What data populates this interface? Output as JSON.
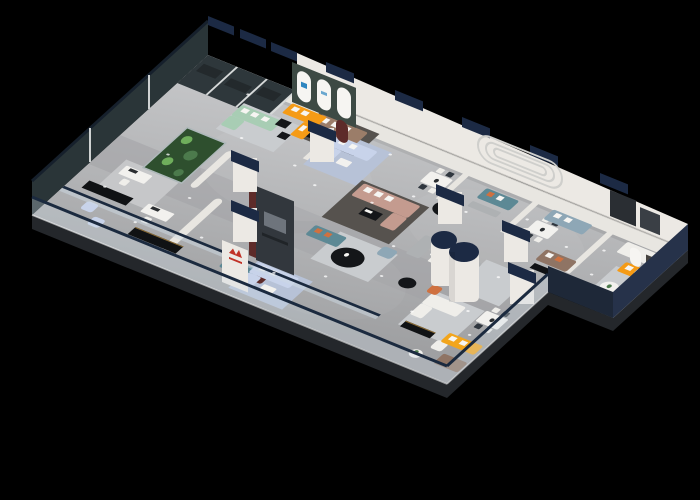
{
  "scene": {
    "description": "Isometric 3D cutaway render of a furniture showroom floor on a black background",
    "background": "#000000",
    "palette": {
      "bg": "#000000",
      "floor_light": "#c6c7c9",
      "floor_base": "#b2b3b5",
      "floor_dark": "#9b9c9e",
      "walkway": "#a2a3a5",
      "slab": "#24272b",
      "wall_white": "#ece9e4",
      "wall_flat": "#e8e6e1",
      "wall_shadow": "#cfccc7",
      "cap_navy": "#1c2a44",
      "glass_dark": "#2e373b",
      "glass_mullion": "#d6d9d9",
      "glass_fill": "#cdd9e4",
      "rail_navy": "#1b2a3f",
      "band_navy": "#1e2838",
      "band_navy_dark": "#26324a",
      "rug_light": "#c9cccf",
      "rug_blue": "#b7c2d7",
      "rug_dark": "#56524e",
      "sofa_white": "#efeeea",
      "sofa_mint": "#a8cdb4",
      "sofa_taupe": "#9b7d69",
      "sofa_brown": "#8f7464",
      "sofa_mauve": "#c49b8f",
      "sofa_bluelight": "#c8d3ea",
      "sofa_teal": "#5d8995",
      "sofa_bluegray": "#8ea7b6",
      "sofa_orange": "#f59b16",
      "sofa_yellow": "#f2a51c",
      "chair_terracotta": "#cf7140",
      "pillow_white": "#f6f5f2",
      "table_black": "#141619",
      "table_white": "#f2f1ee",
      "console_black": "#101214",
      "gold_trim": "#8a6b35",
      "plant_green": "#4c7a4c",
      "plant_bright": "#6fae5c",
      "terrarium_dark": "#2e4f2e",
      "maroon": "#5d2b29",
      "tv_dark": "#32373d",
      "tv_screen": "#6e747c",
      "logo_red": "#c13227",
      "teal_wall": "#3d4a44",
      "art_dark": "#45433f",
      "logo_blue": "#2e86c0",
      "booth_gray": "#aeb1b3",
      "wardrobe_dark": "#2a2e33",
      "spotlight": "#ffffff"
    },
    "zones": [
      {
        "id": "smoked-glass-offices",
        "label": "Smoked glass office suites",
        "items": [
          "tinted glass partitions",
          "office desks",
          "black sideboards",
          "light blue armchairs"
        ]
      },
      {
        "id": "plant-terrarium",
        "label": "Glass plant terrarium",
        "items": [
          "vertical garden"
        ]
      },
      {
        "id": "lounge-left",
        "label": "Left lounge displays",
        "items": [
          "mint green sofa",
          "taupe sofa",
          "black media console"
        ]
      },
      {
        "id": "arched-gallery",
        "label": "Arched gallery niche",
        "items": [
          "sage wall with three white arches",
          "orange sectional sofa",
          "black coffee table"
        ]
      },
      {
        "id": "blue-sofa-room",
        "label": "Light blue sectional room",
        "items": [
          "light blue sectional",
          "white coffee table"
        ]
      },
      {
        "id": "reception",
        "label": "Reception pillar",
        "items": [
          "white pillar with red brand logo",
          "teal sofa",
          "maroon armchair"
        ]
      },
      {
        "id": "central-lounge",
        "label": "Central lounge",
        "items": [
          "charcoal TV feature wall",
          "mauve sectional",
          "teal loveseat with orange pillows",
          "black round coffee tables",
          "blue ottoman"
        ]
      },
      {
        "id": "dining-displays",
        "label": "Dining table displays",
        "items": [
          "white dining tables with chairs",
          "gray booth benches"
        ]
      },
      {
        "id": "column-lounge",
        "label": "Cylindrical column lounge",
        "items": [
          "white column with navy cap",
          "navy-capped column",
          "terracotta barrel chairs"
        ]
      },
      {
        "id": "right-gallery",
        "label": "Right gallery displays",
        "items": [
          "blue-gray sofa",
          "brown sofa with orange pillows",
          "racetrack wall relief",
          "dark wardrobe"
        ]
      },
      {
        "id": "east-alcove",
        "label": "East orange alcove",
        "items": [
          "orange sectional",
          "arched wall art",
          "round side table"
        ]
      },
      {
        "id": "front-bay",
        "label": "Front glass bay",
        "items": [
          "white sofas",
          "yellow sofa",
          "black sideboard with gold trim",
          "plant side table",
          "white slipper chair"
        ]
      },
      {
        "id": "balustrade",
        "label": "Glass balustrade",
        "items": [
          "frameless glass panels",
          "navy handrail"
        ]
      },
      {
        "id": "lighting",
        "label": "Ceiling spotlights",
        "items": [
          "recessed spot lights"
        ]
      }
    ]
  }
}
